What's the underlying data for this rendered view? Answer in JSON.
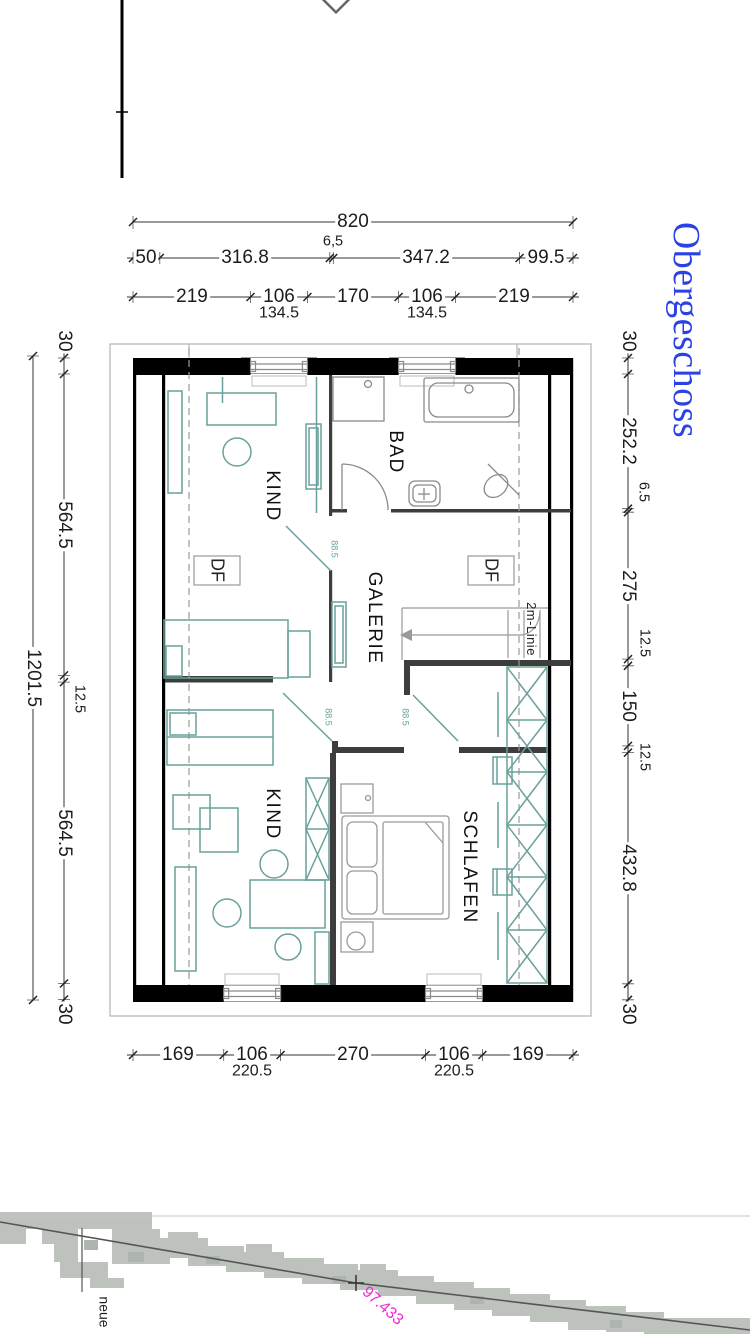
{
  "title": {
    "text": "Obergeschoss",
    "color": "#2a41e6"
  },
  "rooms": {
    "kind_top": "KIND",
    "bad": "BAD",
    "galerie": "GALERIE",
    "kind_bottom": "KIND",
    "schlafen": "SCHLAFEN"
  },
  "roof_windows": {
    "df_left": "DF",
    "df_right": "DF"
  },
  "annotations": {
    "two_meter_line": "2m-Linie",
    "door_top": "88.5",
    "door_left": "88.5",
    "door_right": "88.5",
    "terrain_elevation": "97.433",
    "terrain_note": "neue"
  },
  "dimensions": {
    "top_total": "820",
    "top_chain": [
      "50",
      "316.8",
      "6,5",
      "347.2",
      "99.5"
    ],
    "top_openings": [
      "219",
      "106",
      "170",
      "106",
      "219"
    ],
    "top_sills": [
      "134.5",
      "134.5"
    ],
    "bottom_openings": [
      "169",
      "106",
      "270",
      "106",
      "169"
    ],
    "bottom_sills": [
      "220.5",
      "220.5"
    ],
    "left_total": "1201.5",
    "left_chain": [
      "30",
      "564.5",
      "12.5",
      "564.5",
      "30"
    ],
    "right_chain": [
      "30",
      "252.2",
      "6.5",
      "275",
      "12.5",
      "150",
      "12.5",
      "432.8",
      "30"
    ]
  },
  "colors": {
    "title_blue": "#2a41e6",
    "furniture_teal": "#69a09b",
    "elevation_magenta": "#ee28d8",
    "wall_black": "#000000",
    "terrain_gray": "#bdc2bc"
  }
}
